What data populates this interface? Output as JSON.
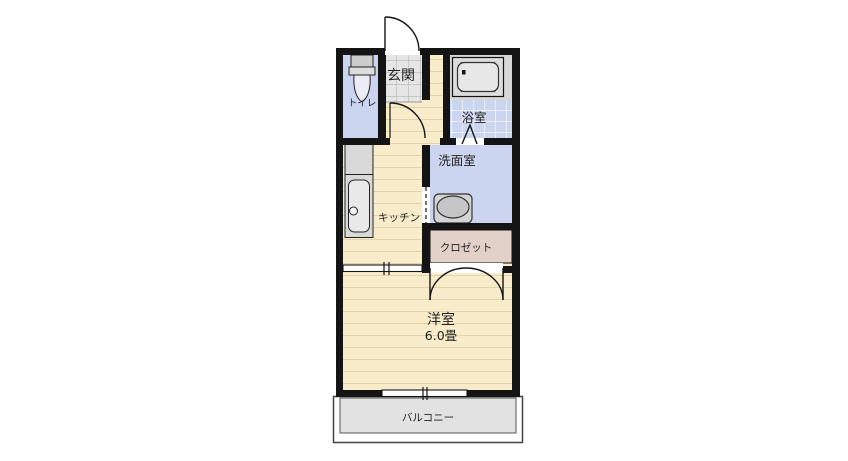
{
  "title": "apartment-floor-plan",
  "rooms": {
    "genkan": {
      "label": "玄関"
    },
    "toilet": {
      "label": "トイレ"
    },
    "bathroom": {
      "label": "浴室"
    },
    "washroom": {
      "label": "洗面室"
    },
    "kitchen": {
      "label": "キッチン"
    },
    "closet": {
      "label": "クロゼット"
    },
    "western_room": {
      "label": "洋室",
      "size": "6.0畳"
    },
    "balcony": {
      "label": "バルコニー"
    }
  },
  "icons": {
    "toilet_icon": "toilet tank and bowl",
    "bathtub_icon": "bathtub",
    "washbasin_icon": "wash basin",
    "kitchen_sink_icon": "kitchen counter with sink"
  },
  "colors": {
    "wall": "#141414",
    "floor": "#f8ecca",
    "floor_stripe": "#e2d3ab",
    "wet_area": "#ccd5f0",
    "tile_line": "#ffffff",
    "genkan_tile": "#e6e6e6",
    "genkan_tile_line": "#aaaaaa",
    "closet": "#e2d1c9",
    "balcony": "#e2e2e2",
    "fixture_gray": "#d9d9d9",
    "fixture_light": "#e9e9e9",
    "text": "#222222"
  }
}
